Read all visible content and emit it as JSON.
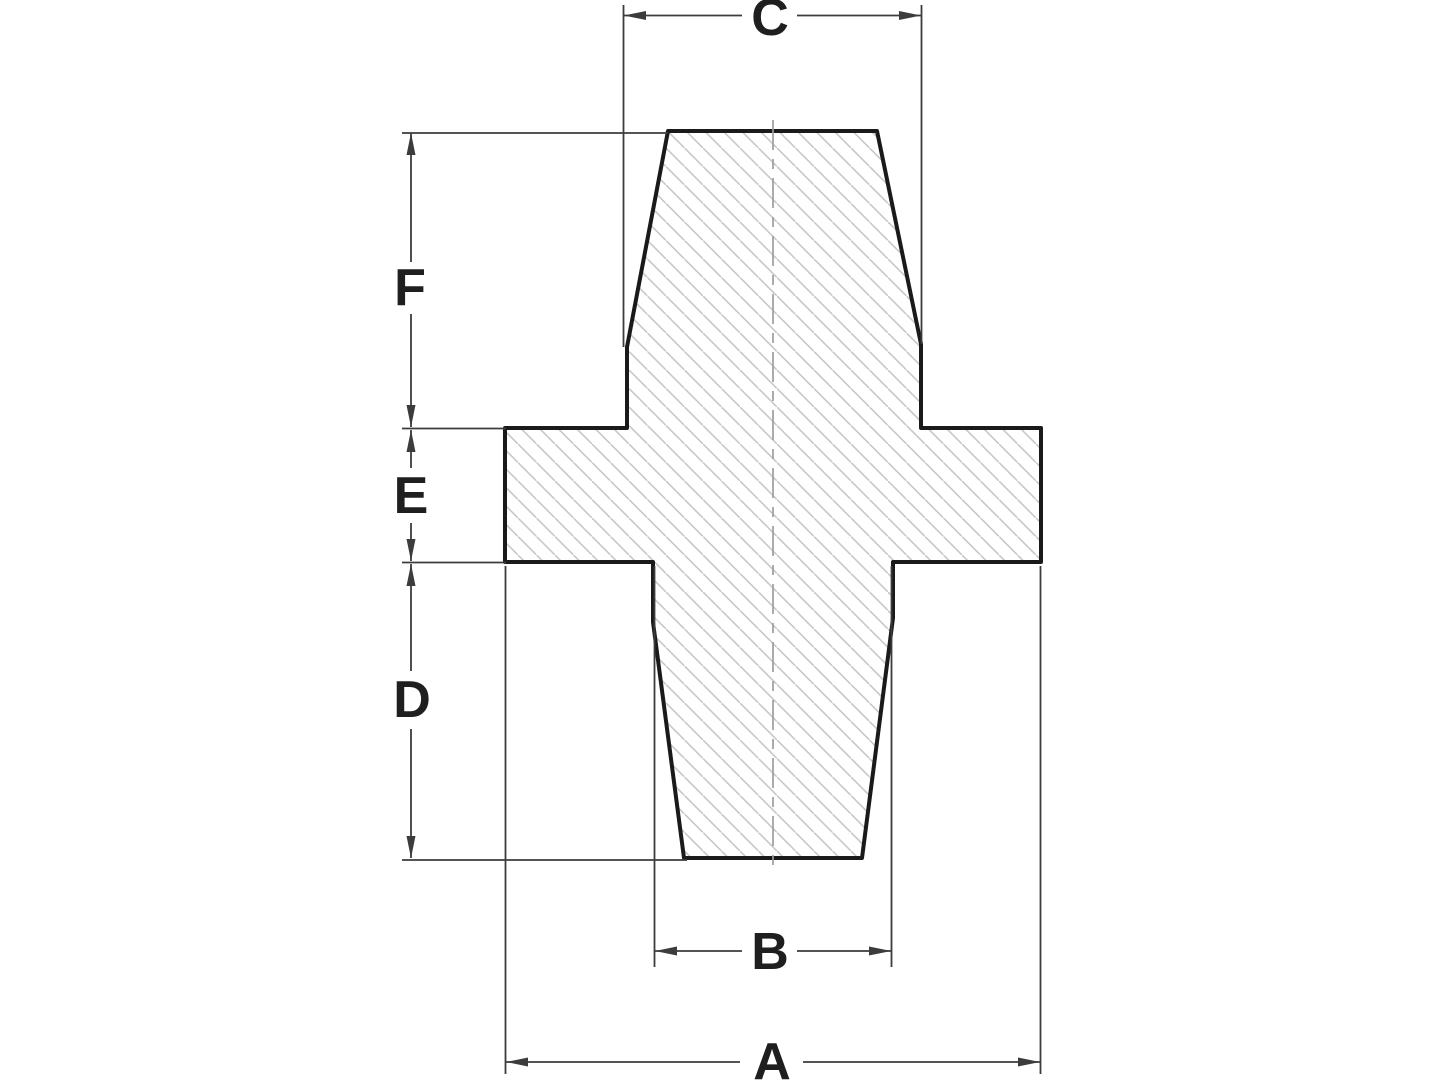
{
  "drawing": {
    "description": "Cross-section technical drawing of a stepped plug/grommet with hatched section, vertical centerline and six reference dimensions",
    "colors": {
      "background": "#ffffff",
      "outline": "#1a1a1a",
      "hatch": "#c7c7c7",
      "centerline": "#9e9e9e",
      "dimension": "#3c3c3c",
      "label": "#1f1f1f"
    },
    "dimensions": {
      "c": {
        "label": "C",
        "orientation": "horizontal",
        "position": "top",
        "spans": "upper-section-width"
      },
      "f": {
        "label": "F",
        "orientation": "vertical",
        "position": "left",
        "spans": "upper-section-height"
      },
      "e": {
        "label": "E",
        "orientation": "vertical",
        "position": "left",
        "spans": "flange-thickness"
      },
      "d": {
        "label": "D",
        "orientation": "vertical",
        "position": "left",
        "spans": "lower-section-height"
      },
      "b": {
        "label": "B",
        "orientation": "horizontal",
        "position": "bottom",
        "spans": "lower-section-width"
      },
      "a": {
        "label": "A",
        "orientation": "horizontal",
        "position": "bottom",
        "spans": "overall-flange-width"
      }
    }
  }
}
